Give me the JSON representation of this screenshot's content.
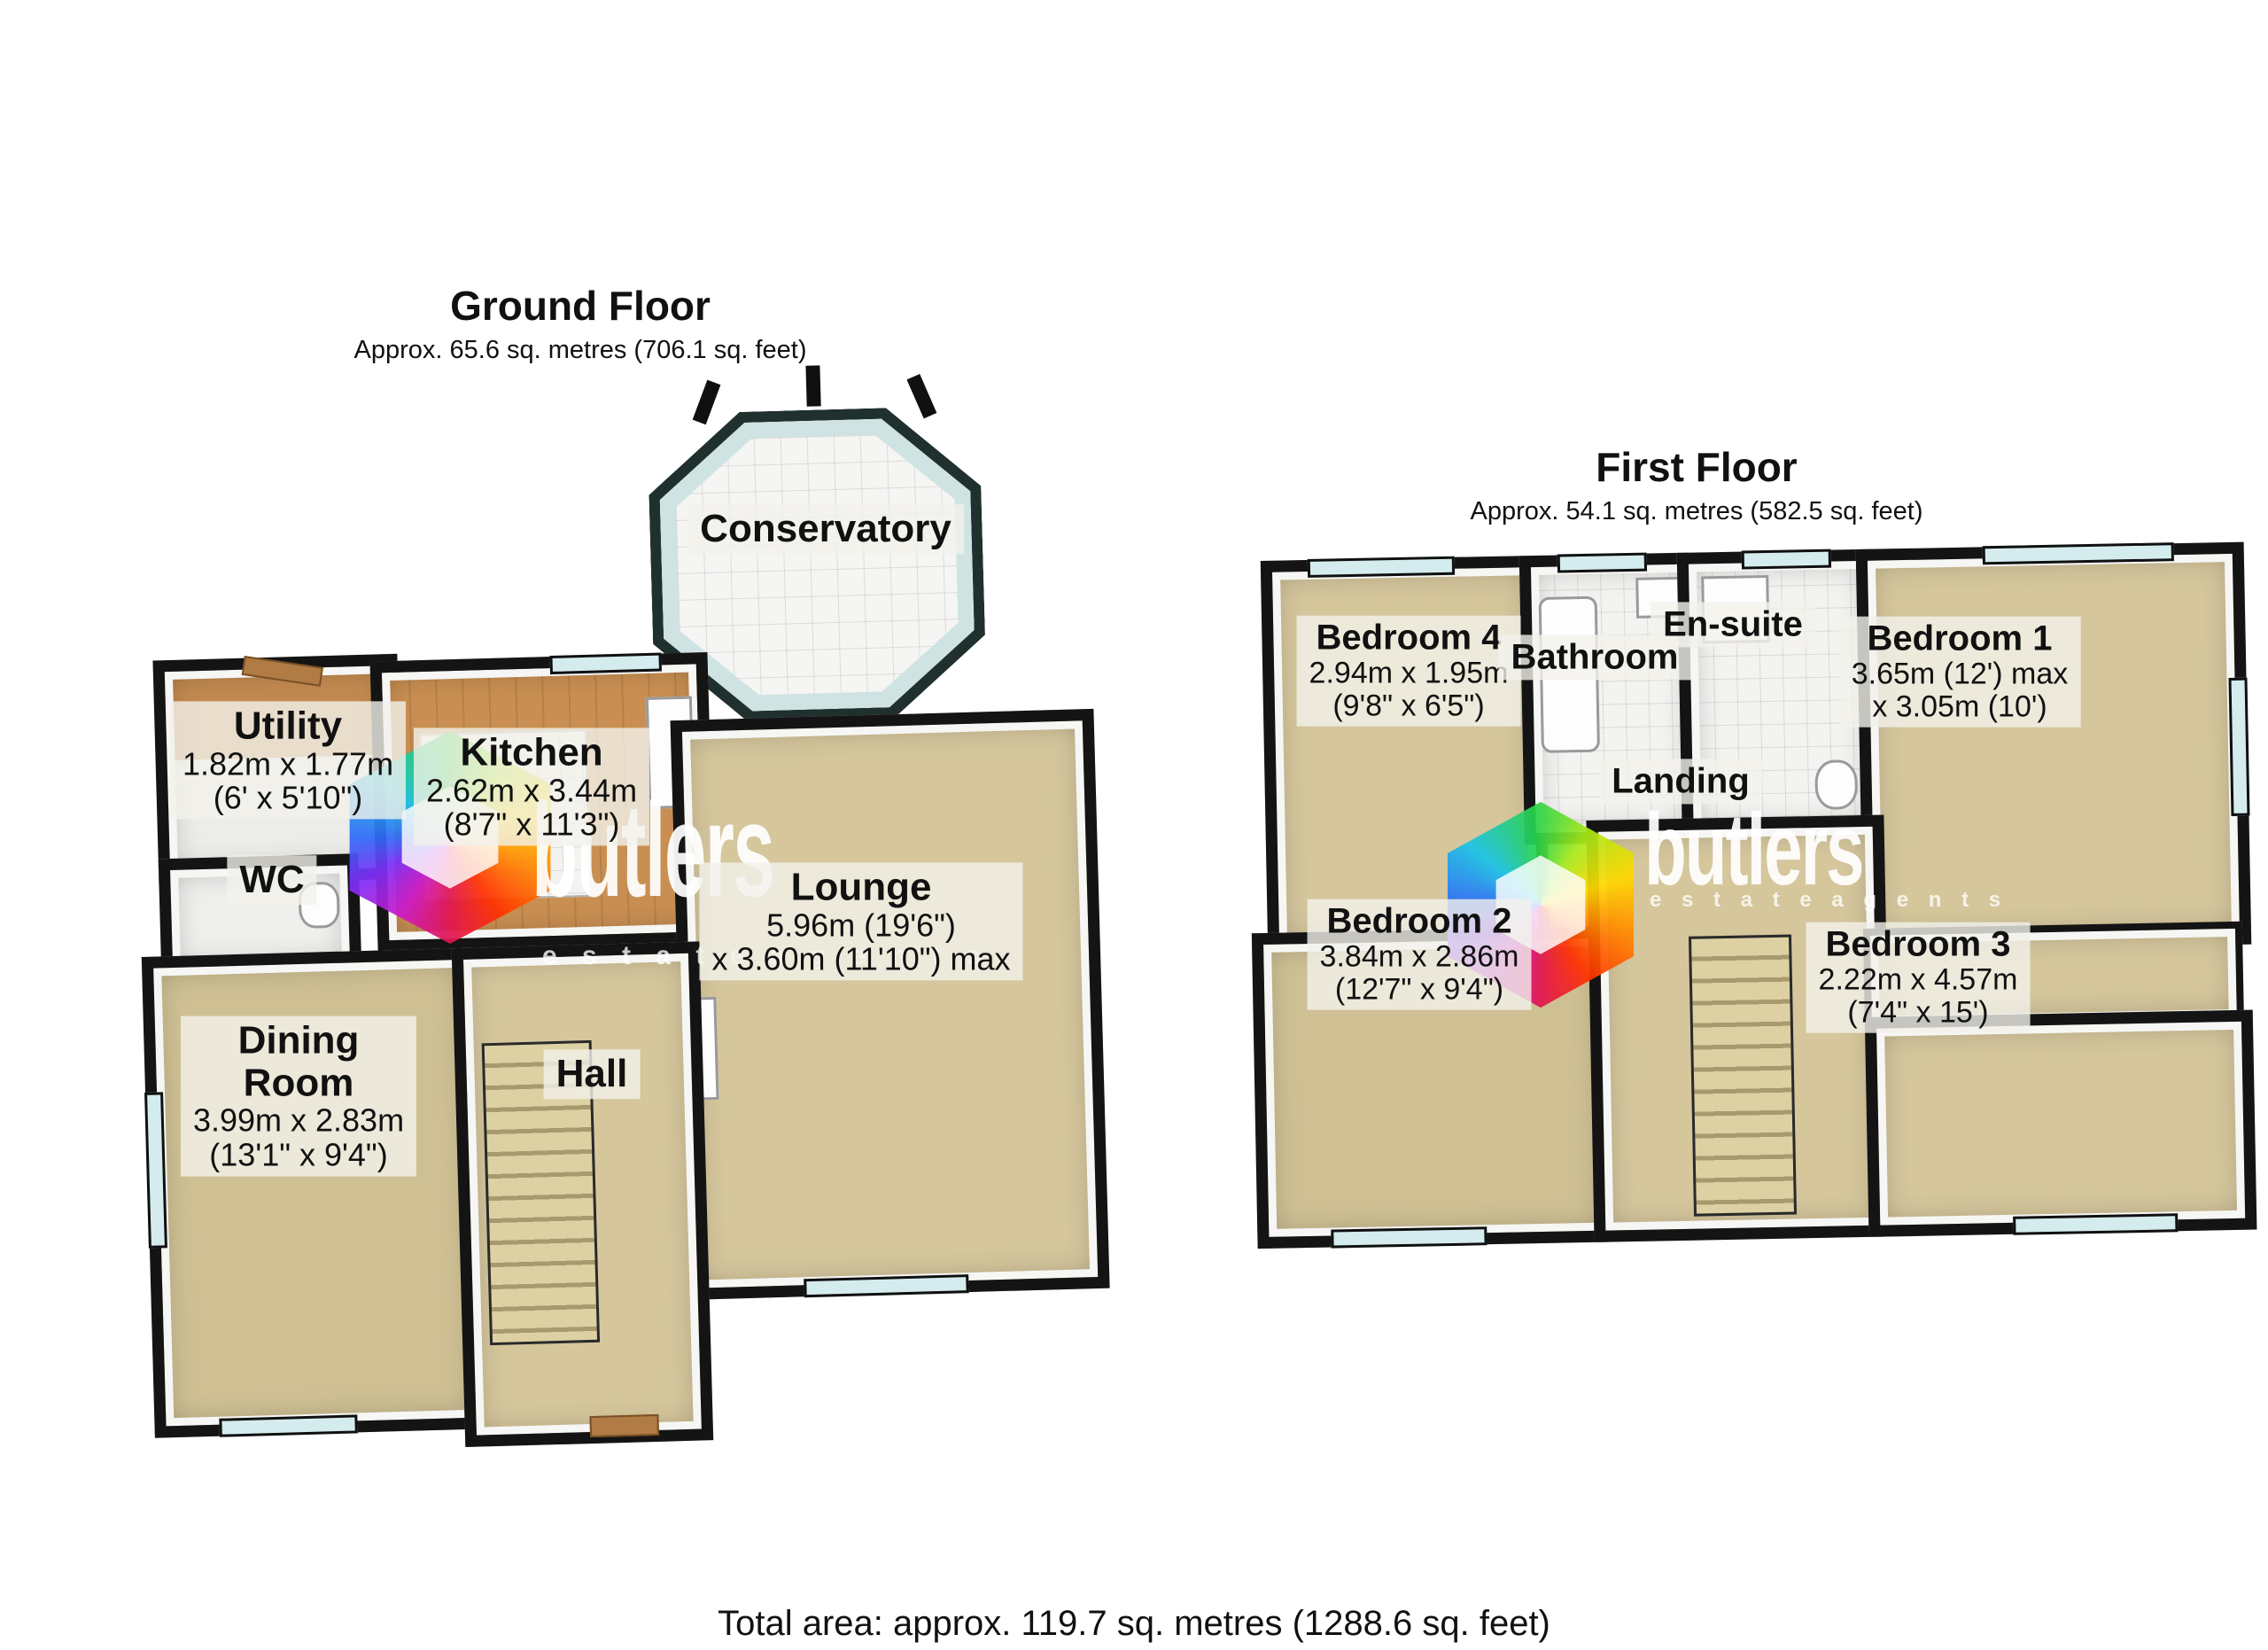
{
  "branding": {
    "logo_name": "butlers",
    "tagline": "e s t a t e   a g e n t s"
  },
  "footer": {
    "total_area": "Total area: approx. 119.7 sq. metres (1288.6 sq. feet)"
  },
  "ground_floor": {
    "title": "Ground Floor",
    "subtitle": "Approx. 65.6 sq. metres (706.1 sq. feet)",
    "rooms": {
      "conservatory": {
        "name": "Conservatory"
      },
      "utility": {
        "name": "Utility",
        "dim1": "1.82m x 1.77m",
        "dim2": "(6' x 5'10\")"
      },
      "kitchen": {
        "name": "Kitchen",
        "dim1": "2.62m x 3.44m",
        "dim2": "(8'7\" x 11'3\")"
      },
      "wc": {
        "name": "WC"
      },
      "lounge": {
        "name": "Lounge",
        "dim1": "5.96m (19'6\")",
        "dim2": "x 3.60m (11'10\") max"
      },
      "dining": {
        "name_line1": "Dining",
        "name_line2": "Room",
        "dim1": "3.99m x 2.83m",
        "dim2": "(13'1\" x 9'4\")"
      },
      "hall": {
        "name": "Hall"
      }
    }
  },
  "first_floor": {
    "title": "First Floor",
    "subtitle": "Approx. 54.1 sq. metres (582.5 sq. feet)",
    "rooms": {
      "bedroom4": {
        "name": "Bedroom 4",
        "dim1": "2.94m x 1.95m",
        "dim2": "(9'8\" x 6'5\")"
      },
      "bathroom": {
        "name": "Bathroom"
      },
      "ensuite": {
        "name": "En-suite"
      },
      "bedroom1": {
        "name": "Bedroom 1",
        "dim1": "3.65m (12') max",
        "dim2": "x 3.05m (10')"
      },
      "landing": {
        "name": "Landing"
      },
      "bedroom2": {
        "name": "Bedroom 2",
        "dim1": "3.84m x 2.86m",
        "dim2": "(12'7\" x 9'4\")"
      },
      "bedroom3": {
        "name": "Bedroom 3",
        "dim1": "2.22m x 4.57m",
        "dim2": "(7'4\" x 15')"
      }
    }
  },
  "colors": {
    "floor_tan": "#d5c69c",
    "floor_wood": "#c98f52",
    "wall": "#141414",
    "window_glass": "#d5ecee",
    "label_bg": "rgba(243,241,235,0.80)"
  }
}
